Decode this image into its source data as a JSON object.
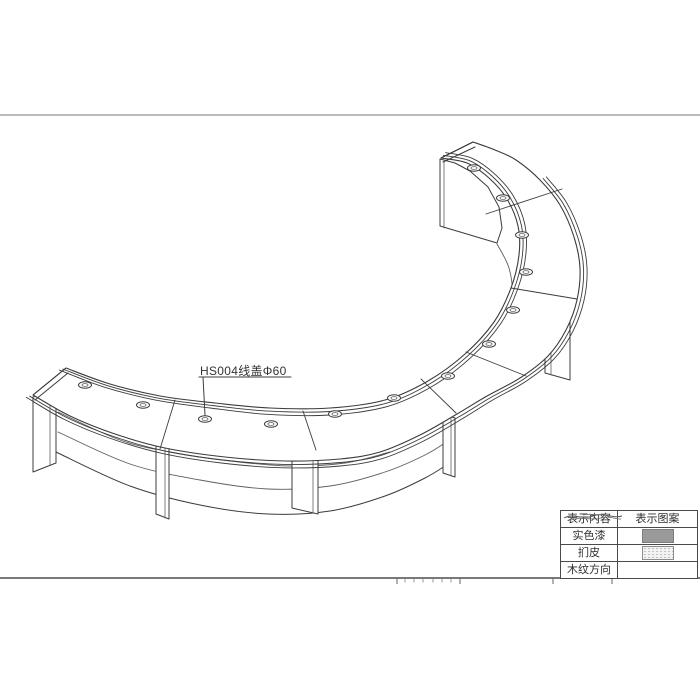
{
  "annotation": {
    "label_text": "HS004线盖Φ60"
  },
  "legend": {
    "header": [
      "表示内容",
      "表示图案"
    ],
    "rows": [
      "实色漆",
      "扪皮",
      "木纹方向"
    ],
    "swatches": [
      "solid-paint",
      "upholstery-stipple",
      "wood-grain"
    ]
  },
  "colors": {
    "line": "#3c3c3c",
    "light_line": "#5f5f5f",
    "frame_top": "#a5a5a5",
    "frame_bottom": "#4f4f4f",
    "solid_swatch": "#9a9a9a",
    "text": "#2f2f2f"
  },
  "drawing": {
    "frame": {
      "top_y": 115,
      "bottom_y": 578,
      "width": 700
    },
    "offset_center": [
      330,
      285
    ],
    "outer_edge": [
      [
        33,
        395
      ],
      [
        70,
        416
      ],
      [
        115,
        434
      ],
      [
        165,
        448
      ],
      [
        225,
        457
      ],
      [
        285,
        461
      ],
      [
        340,
        459
      ],
      [
        380,
        452
      ],
      [
        420,
        435
      ],
      [
        457,
        414
      ],
      [
        487,
        396
      ],
      [
        520,
        378
      ],
      [
        548,
        356
      ],
      [
        566,
        330
      ],
      [
        577,
        300
      ],
      [
        580,
        268
      ],
      [
        574,
        237
      ],
      [
        560,
        205
      ],
      [
        540,
        180
      ],
      [
        516,
        160
      ],
      [
        495,
        150
      ],
      [
        473,
        142
      ]
    ],
    "inner_edge": [
      [
        66,
        368
      ],
      [
        110,
        384
      ],
      [
        160,
        396
      ],
      [
        215,
        403
      ],
      [
        270,
        408
      ],
      [
        330,
        408
      ],
      [
        385,
        400
      ],
      [
        428,
        381
      ],
      [
        465,
        354
      ],
      [
        494,
        322
      ],
      [
        511,
        288
      ],
      [
        519,
        255
      ],
      [
        518,
        226
      ],
      [
        507,
        199
      ],
      [
        489,
        178
      ],
      [
        467,
        163
      ],
      [
        441,
        158
      ]
    ],
    "trim_offsets": [
      3.5,
      7
    ],
    "thickness_offsets": [
      3.5,
      7
    ],
    "thickness_last_index": 18,
    "end_caps": [
      [
        [
          33,
          395
        ],
        [
          66,
          368
        ]
      ],
      [
        [
          35,
          400
        ],
        [
          68,
          373
        ]
      ],
      [
        [
          473,
          142
        ],
        [
          441,
          158
        ]
      ],
      [
        [
          475,
          147
        ],
        [
          443,
          162
        ]
      ]
    ],
    "divisions": [
      [
        [
          175,
          400
        ],
        [
          160,
          449
        ]
      ],
      [
        [
          303,
          411
        ],
        [
          316,
          450
        ]
      ],
      [
        [
          421,
          379
        ],
        [
          456,
          413
        ]
      ],
      [
        [
          466,
          352
        ],
        [
          526,
          376
        ]
      ],
      [
        [
          511,
          288
        ],
        [
          577,
          299
        ]
      ],
      [
        [
          486,
          214
        ],
        [
          562,
          189
        ]
      ]
    ],
    "grommets": [
      [
        85,
        385
      ],
      [
        143,
        405
      ],
      [
        205,
        419
      ],
      [
        271,
        424
      ],
      [
        335,
        414
      ],
      [
        394,
        398
      ],
      [
        448,
        376
      ],
      [
        489,
        344
      ],
      [
        513,
        310
      ],
      [
        526,
        272
      ],
      [
        522,
        235
      ],
      [
        503,
        198
      ],
      [
        474,
        168
      ]
    ],
    "rail": [
      [
        58,
        412
      ],
      [
        120,
        440
      ],
      [
        170,
        452
      ],
      [
        230,
        461
      ],
      [
        290,
        466
      ],
      [
        345,
        463
      ],
      [
        390,
        452
      ]
    ],
    "apron_top": [
      [
        58,
        432
      ],
      [
        130,
        464
      ],
      [
        200,
        480
      ],
      [
        268,
        489
      ],
      [
        330,
        486
      ],
      [
        385,
        472
      ],
      [
        425,
        455
      ],
      [
        448,
        441
      ]
    ],
    "apron_bottom": [
      [
        56,
        452
      ],
      [
        130,
        486
      ],
      [
        200,
        505
      ],
      [
        268,
        514
      ],
      [
        330,
        511
      ],
      [
        385,
        496
      ],
      [
        425,
        478
      ],
      [
        448,
        464
      ]
    ],
    "inner_face": [
      [
        497,
        244
      ],
      [
        509,
        268
      ],
      [
        512,
        296
      ],
      [
        503,
        330
      ],
      [
        485,
        360
      ],
      [
        458,
        386
      ],
      [
        428,
        402
      ]
    ],
    "back_corner_drop": [
      [
        66,
        369
      ],
      [
        66,
        412
      ]
    ],
    "legs": [
      [
        [
          33,
          397
        ],
        [
          56,
          388
        ],
        [
          56,
          463
        ],
        [
          33,
          472
        ]
      ],
      [
        [
          156,
          430
        ],
        [
          169,
          435
        ],
        [
          169,
          519
        ],
        [
          156,
          514
        ]
      ],
      [
        [
          292,
          453
        ],
        [
          318,
          459
        ],
        [
          318,
          514
        ],
        [
          292,
          508
        ]
      ],
      [
        [
          443,
          414
        ],
        [
          455,
          418
        ],
        [
          455,
          477
        ],
        [
          443,
          473
        ]
      ],
      [
        [
          545,
          300
        ],
        [
          570,
          307
        ],
        [
          570,
          380
        ],
        [
          545,
          373
        ]
      ]
    ],
    "leg_inner_lines": [
      [
        [
          50,
          390
        ],
        [
          50,
          465
        ]
      ],
      [
        [
          165,
          434
        ],
        [
          165,
          518
        ]
      ],
      [
        [
          313,
          458
        ],
        [
          313,
          513
        ]
      ],
      [
        [
          451,
          417
        ],
        [
          451,
          476
        ]
      ],
      [
        [
          551,
          302
        ],
        [
          551,
          375
        ]
      ]
    ],
    "end_panel": [
      [
        440,
        159
      ],
      [
        440,
        226
      ],
      [
        497,
        243
      ],
      [
        502,
        228
      ],
      [
        499,
        207
      ],
      [
        488,
        187
      ],
      [
        470,
        171
      ],
      [
        455,
        163
      ]
    ],
    "end_panel_line": [
      [
        444,
        162
      ],
      [
        444,
        228
      ]
    ],
    "leader": {
      "from": [
        203,
        377
      ],
      "to": [
        205,
        415
      ],
      "underline": [
        [
          199,
          377
        ],
        [
          291,
          377
        ]
      ]
    },
    "bottom_ticks_x": [
      397,
      460,
      553,
      612
    ],
    "bottom_ticks_y": [
      578,
      584
    ],
    "cropped_glyph_marks_x": [
      405,
      414,
      423,
      433,
      442,
      451
    ]
  }
}
